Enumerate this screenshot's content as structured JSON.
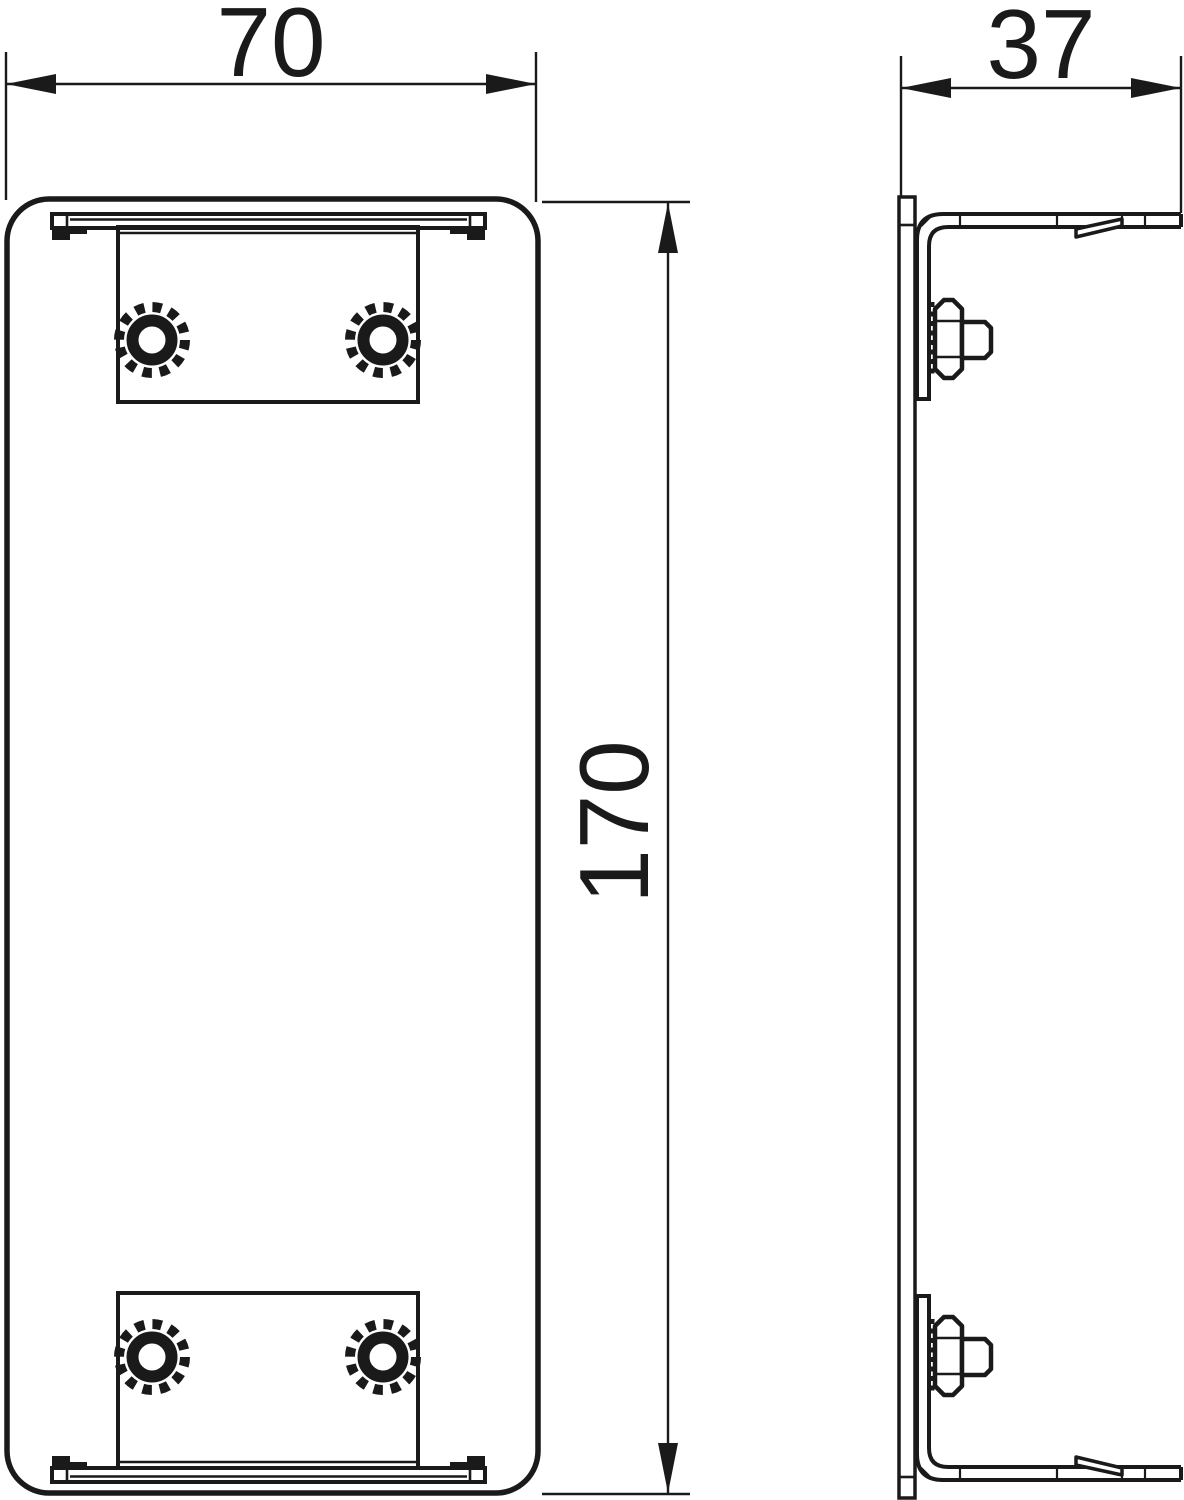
{
  "drawing": {
    "type": "technical-dimension-drawing",
    "dimensions": {
      "width": "70",
      "depth": "37",
      "height": "170"
    },
    "colors": {
      "line": "#1a1a1a",
      "background": "#ffffff"
    }
  }
}
